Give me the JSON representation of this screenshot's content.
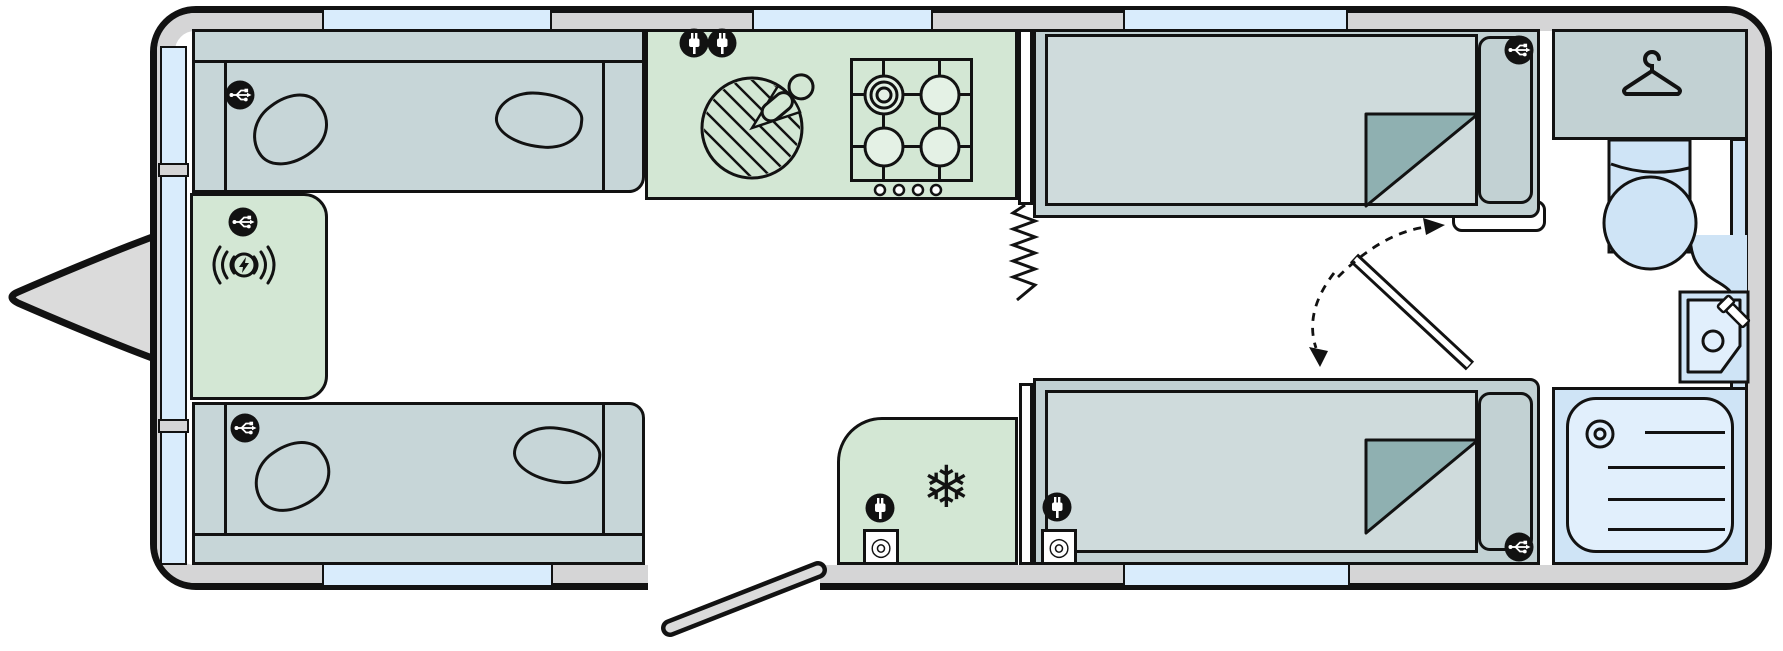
{
  "diagram": {
    "type": "caravan-floorplan",
    "orientation": "hitch-on-left",
    "zones": [
      {
        "id": "front-lounge",
        "label": "Front lounge",
        "items": [
          "top-sofa-with-2-pillows",
          "bottom-sofa-with-2-pillows",
          "front-chest-with-wireless-charging-pad"
        ],
        "icons": [
          "usb-icon",
          "usb-icon",
          "usb-icon",
          "wireless-charging-icon"
        ]
      },
      {
        "id": "kitchen",
        "label": "Kitchen",
        "items": [
          "round-sink-with-tap",
          "hob-4-burner-with-4-control-knobs",
          "partition-wall-with-concertina-divider"
        ],
        "icons": [
          "plug-icon",
          "plug-icon"
        ]
      },
      {
        "id": "bedroom",
        "label": "Twin single bedroom",
        "items": [
          "single-bed-top-folded-corner",
          "single-bed-bottom-folded-corner",
          "divider-door-with-swing-arrows",
          "fridge"
        ],
        "icons": [
          "usb-icon",
          "usb-icon",
          "plug-icon",
          "plug-icon",
          "aerial-socket-icon",
          "aerial-socket-icon",
          "snowflake-icon"
        ]
      },
      {
        "id": "washroom",
        "label": "Rear washroom",
        "items": [
          "wardrobe",
          "toilet",
          "corner-basin-with-tap",
          "shower-tray"
        ],
        "icons": [
          "hanger-icon"
        ]
      }
    ],
    "windows": {
      "top_wall": 3,
      "bottom_wall": 2,
      "front_wall_segments": 3
    },
    "doors": [
      "entrance-door-open-bottom",
      "bedroom-divider-door"
    ]
  },
  "glyphs": {
    "snowflake": "❄",
    "socket_ring": "◎"
  },
  "colors": {
    "outline": "#121212",
    "wall": "#d5d5d6",
    "window": "#d9ecfc",
    "sofa": "#c7d6d8",
    "bedframe": "#c2d1d3",
    "mattress": "#cfdbdc",
    "fold": "#8fb0b1",
    "green": "#d3e7d4",
    "burner": "#e4f1e5",
    "bath": "#cfe4f6",
    "tray": "#e1effc",
    "hitch": "#dbdbdb",
    "floor": "#ffffff"
  }
}
